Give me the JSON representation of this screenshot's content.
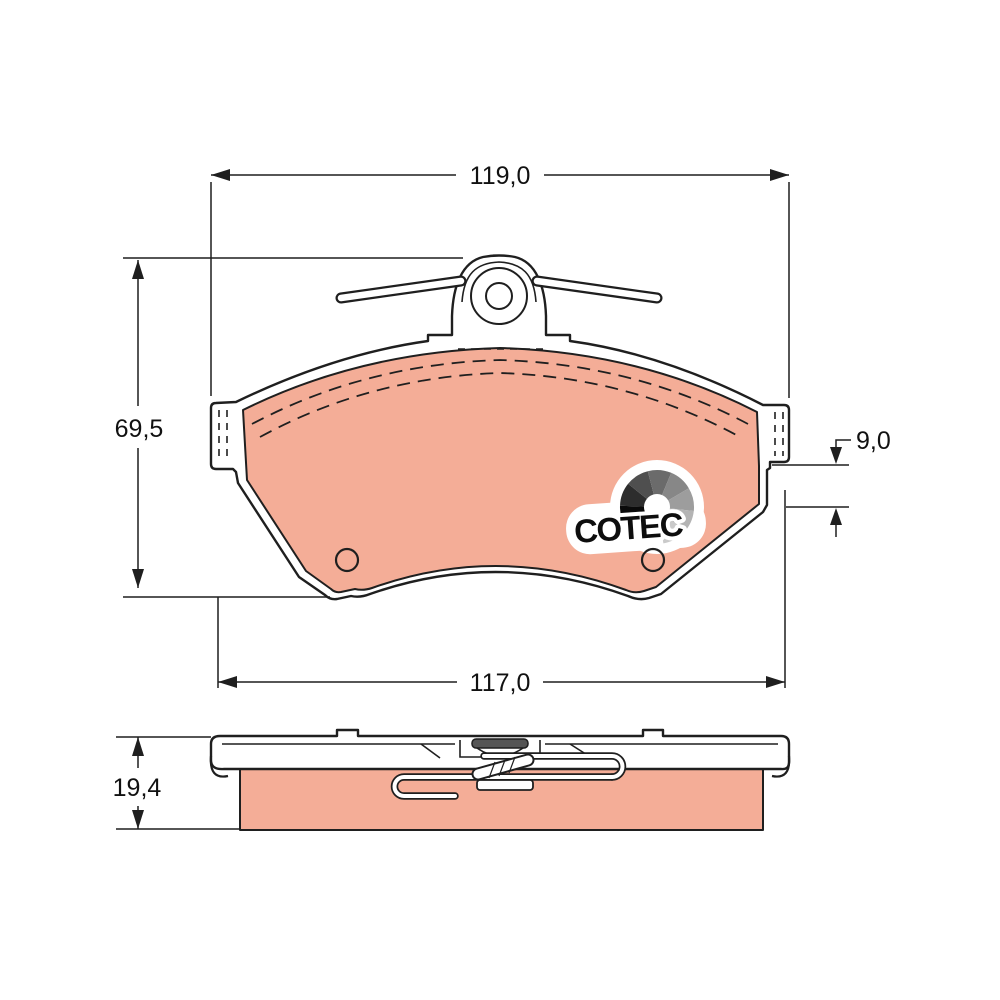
{
  "drawing": {
    "kind": "brake-pad-technical-drawing",
    "views": {
      "front": "front-view-of-pad",
      "side": "bottom-edge-view-of-pad"
    }
  },
  "dimensions": {
    "overall_width": {
      "label": "119,0"
    },
    "overall_height": {
      "label": "69,5"
    },
    "edge_step": {
      "label": "9,0"
    },
    "lower_width": {
      "label": "117,0"
    },
    "side_thickness": {
      "label": "19,4"
    }
  },
  "logo": {
    "text": "COTEC",
    "fan_colors": [
      "#0a0a0a",
      "#2d2d2d",
      "#4f4f4f",
      "#6b6b6b",
      "#878787",
      "#9d9d9d",
      "#b4b4b4",
      "#cacaca"
    ]
  },
  "colors": {
    "background": "#ffffff",
    "plate": "#ffffff",
    "friction": "#f4ad97",
    "line": "#1f1f1f",
    "dim": "#111111",
    "logo_text": "#0d0d0d",
    "tongue": "#555555"
  }
}
